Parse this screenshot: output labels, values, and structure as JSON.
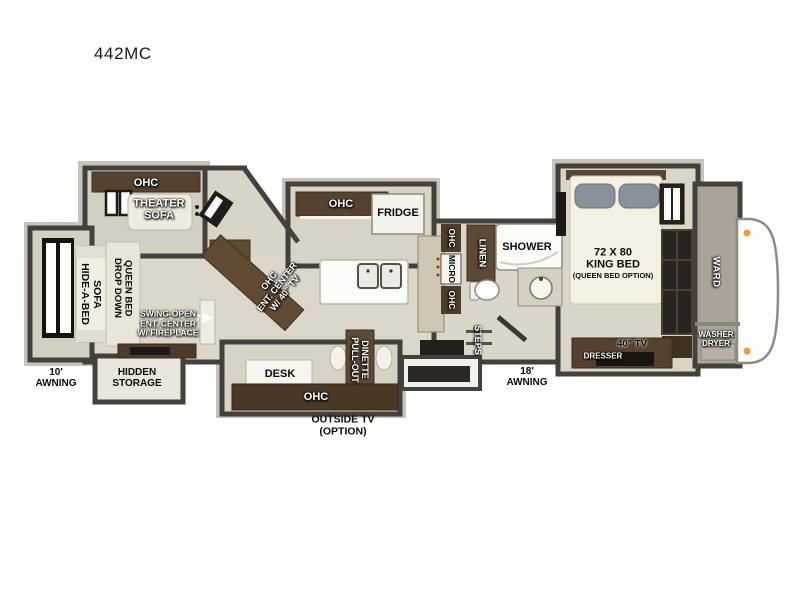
{
  "title": "442MC",
  "colors": {
    "wall": "#44413c",
    "floor": "#dcd8c9",
    "cabinet_brown": "#55432f",
    "marker_orange": "#e79f3c"
  },
  "front_living": {
    "ohc": "OHC",
    "theater_sofa": "THEATER\nSOFA",
    "hide_a_bed": "HIDE-A-BED\nSOFA",
    "drop_down_bed": "DROP DOWN\nQUEEN BED",
    "swing_open": "SWING-OPEN\nENT. CENTER\nW/ FIREPLACE",
    "awning": "10'\nAWNING",
    "hidden_storage": "HIDDEN\nSTORAGE"
  },
  "kitchen": {
    "ohc_top": "OHC",
    "fridge": "FRIDGE",
    "ent_center": "OHC\nENT. CENTER\nW/ 40\" TV",
    "desk": "DESK",
    "dinette": "PULL-OUT\nDINETTE",
    "ohc_bottom": "OHC",
    "outside_tv": "OUTSIDE TV\n(OPTION)"
  },
  "bathroom": {
    "ohc_upper": "OHC",
    "micro": "MICRO",
    "ohc_lower": "OHC",
    "linen": "LINEN",
    "shower": "SHOWER",
    "steps": "STEPS",
    "awning": "18'\nAWNING"
  },
  "bedroom": {
    "bed": "72 X 80\nKING BED",
    "bed_option": "(QUEEN BED OPTION)",
    "ward": "WARD",
    "washer_dryer": "WASHER\nDRYER",
    "tv": "40\" TV",
    "dresser": "DRESSER"
  }
}
